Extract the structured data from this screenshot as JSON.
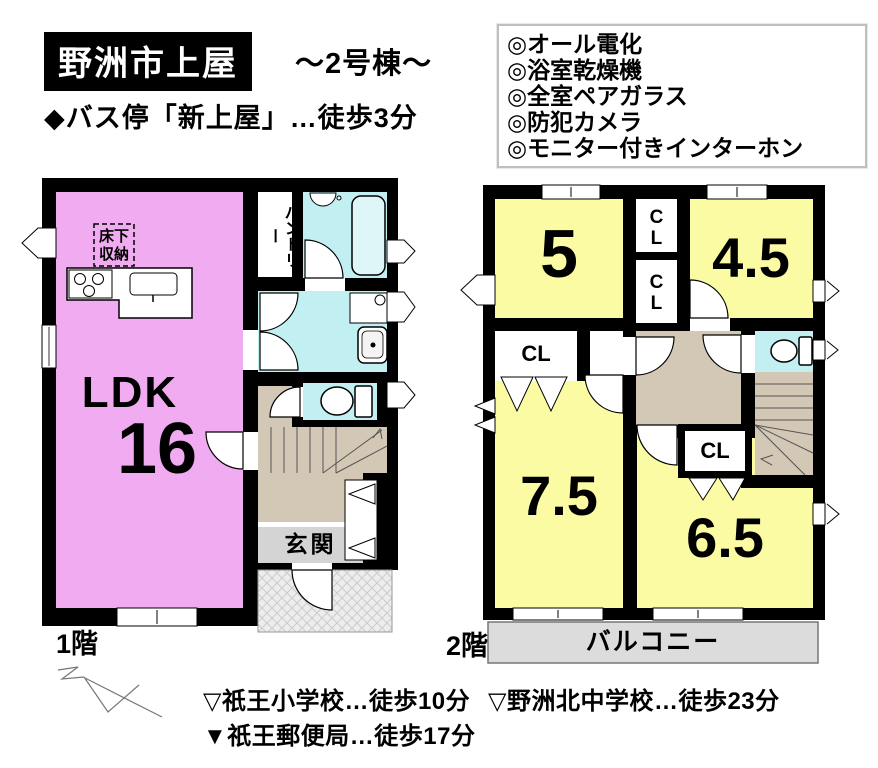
{
  "header": {
    "title": "野洲市上屋",
    "subtitle": "～2号棟～",
    "bus_stop": "◆バス停「新上屋」…徒歩3分",
    "features": [
      "◎オール電化",
      "◎浴室乾燥機",
      "◎全室ペアガラス",
      "◎防犯カメラ",
      "◎モニター付きインターホン"
    ]
  },
  "floor1": {
    "caption": "1階",
    "ldk_label": "LDK",
    "ldk_size": "16",
    "underfloor_line1": "床下",
    "underfloor_line2": "収納",
    "pantry": "パントリー",
    "entrance": "玄関"
  },
  "floor2": {
    "caption": "2階",
    "room_top_left": "5",
    "room_top_right": "4.5",
    "room_bottom_left": "7.5",
    "room_bottom_right": "6.5",
    "closet": "CL",
    "balcony": "バルコニー"
  },
  "footer": {
    "school1": "▽祇王小学校…徒歩10分",
    "school2": "▽野洲北中学校…徒歩23分",
    "post_office": "▼祇王郵便局…徒歩17分"
  },
  "colors": {
    "room_pink": "#F1ACF1",
    "room_yellow": "#FBFBA4",
    "water_cyan": "#C2F0F2",
    "bathtub_cyan": "#DFF6F8",
    "stairs_tan": "#D3C7B5",
    "entrance_gray": "#D4D4D4",
    "porch_gray": "#EDEDED",
    "balcony_gray": "#DCDCDC",
    "wall_black": "#000000"
  }
}
